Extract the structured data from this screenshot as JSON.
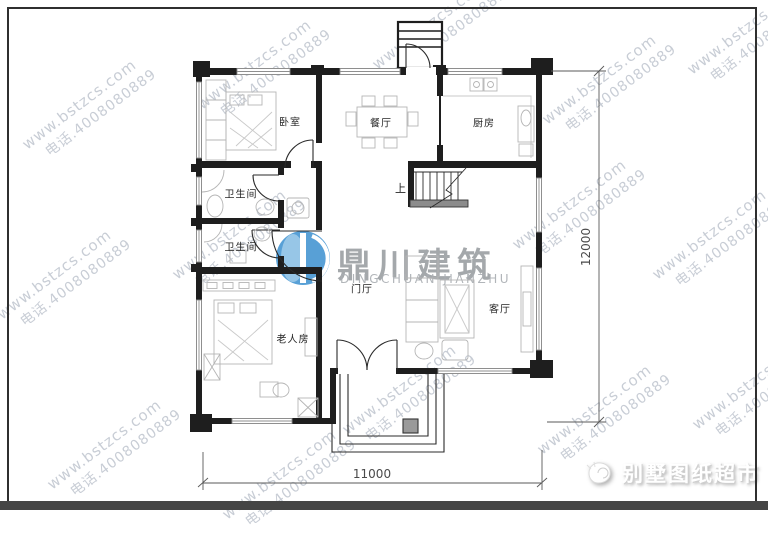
{
  "watermark": {
    "line1": "www.bstzcs.com",
    "line2": "电话.4008080889"
  },
  "logo": {
    "name_cn": "鼎川建筑",
    "name_en": "DINGCHUAN JIANZHU"
  },
  "brand": {
    "name": "别墅图纸超市"
  },
  "plan": {
    "rooms": {
      "bedroom": "卧室",
      "dining": "餐厅",
      "kitchen": "厨房",
      "bathroom1": "卫生间",
      "bathroom2": "卫生间",
      "elderly_room": "老人房",
      "foyer": "门厅",
      "living_room": "客厅",
      "stairs_up": "上"
    },
    "dimensions": {
      "width_mm": "11000",
      "depth_mm": "12000"
    }
  },
  "colors": {
    "wall": "#1e1e1e",
    "furniture_line": "#b5b5b5",
    "watermark_text": "#b3bac6",
    "logo_blue": "#4796d2",
    "logo_gray": "#9b9fa3",
    "dimension_line": "#5a5a5a",
    "frame_border": "#2f2f2f",
    "bottom_bar": "#454545",
    "brand_text": "#ffffff"
  }
}
